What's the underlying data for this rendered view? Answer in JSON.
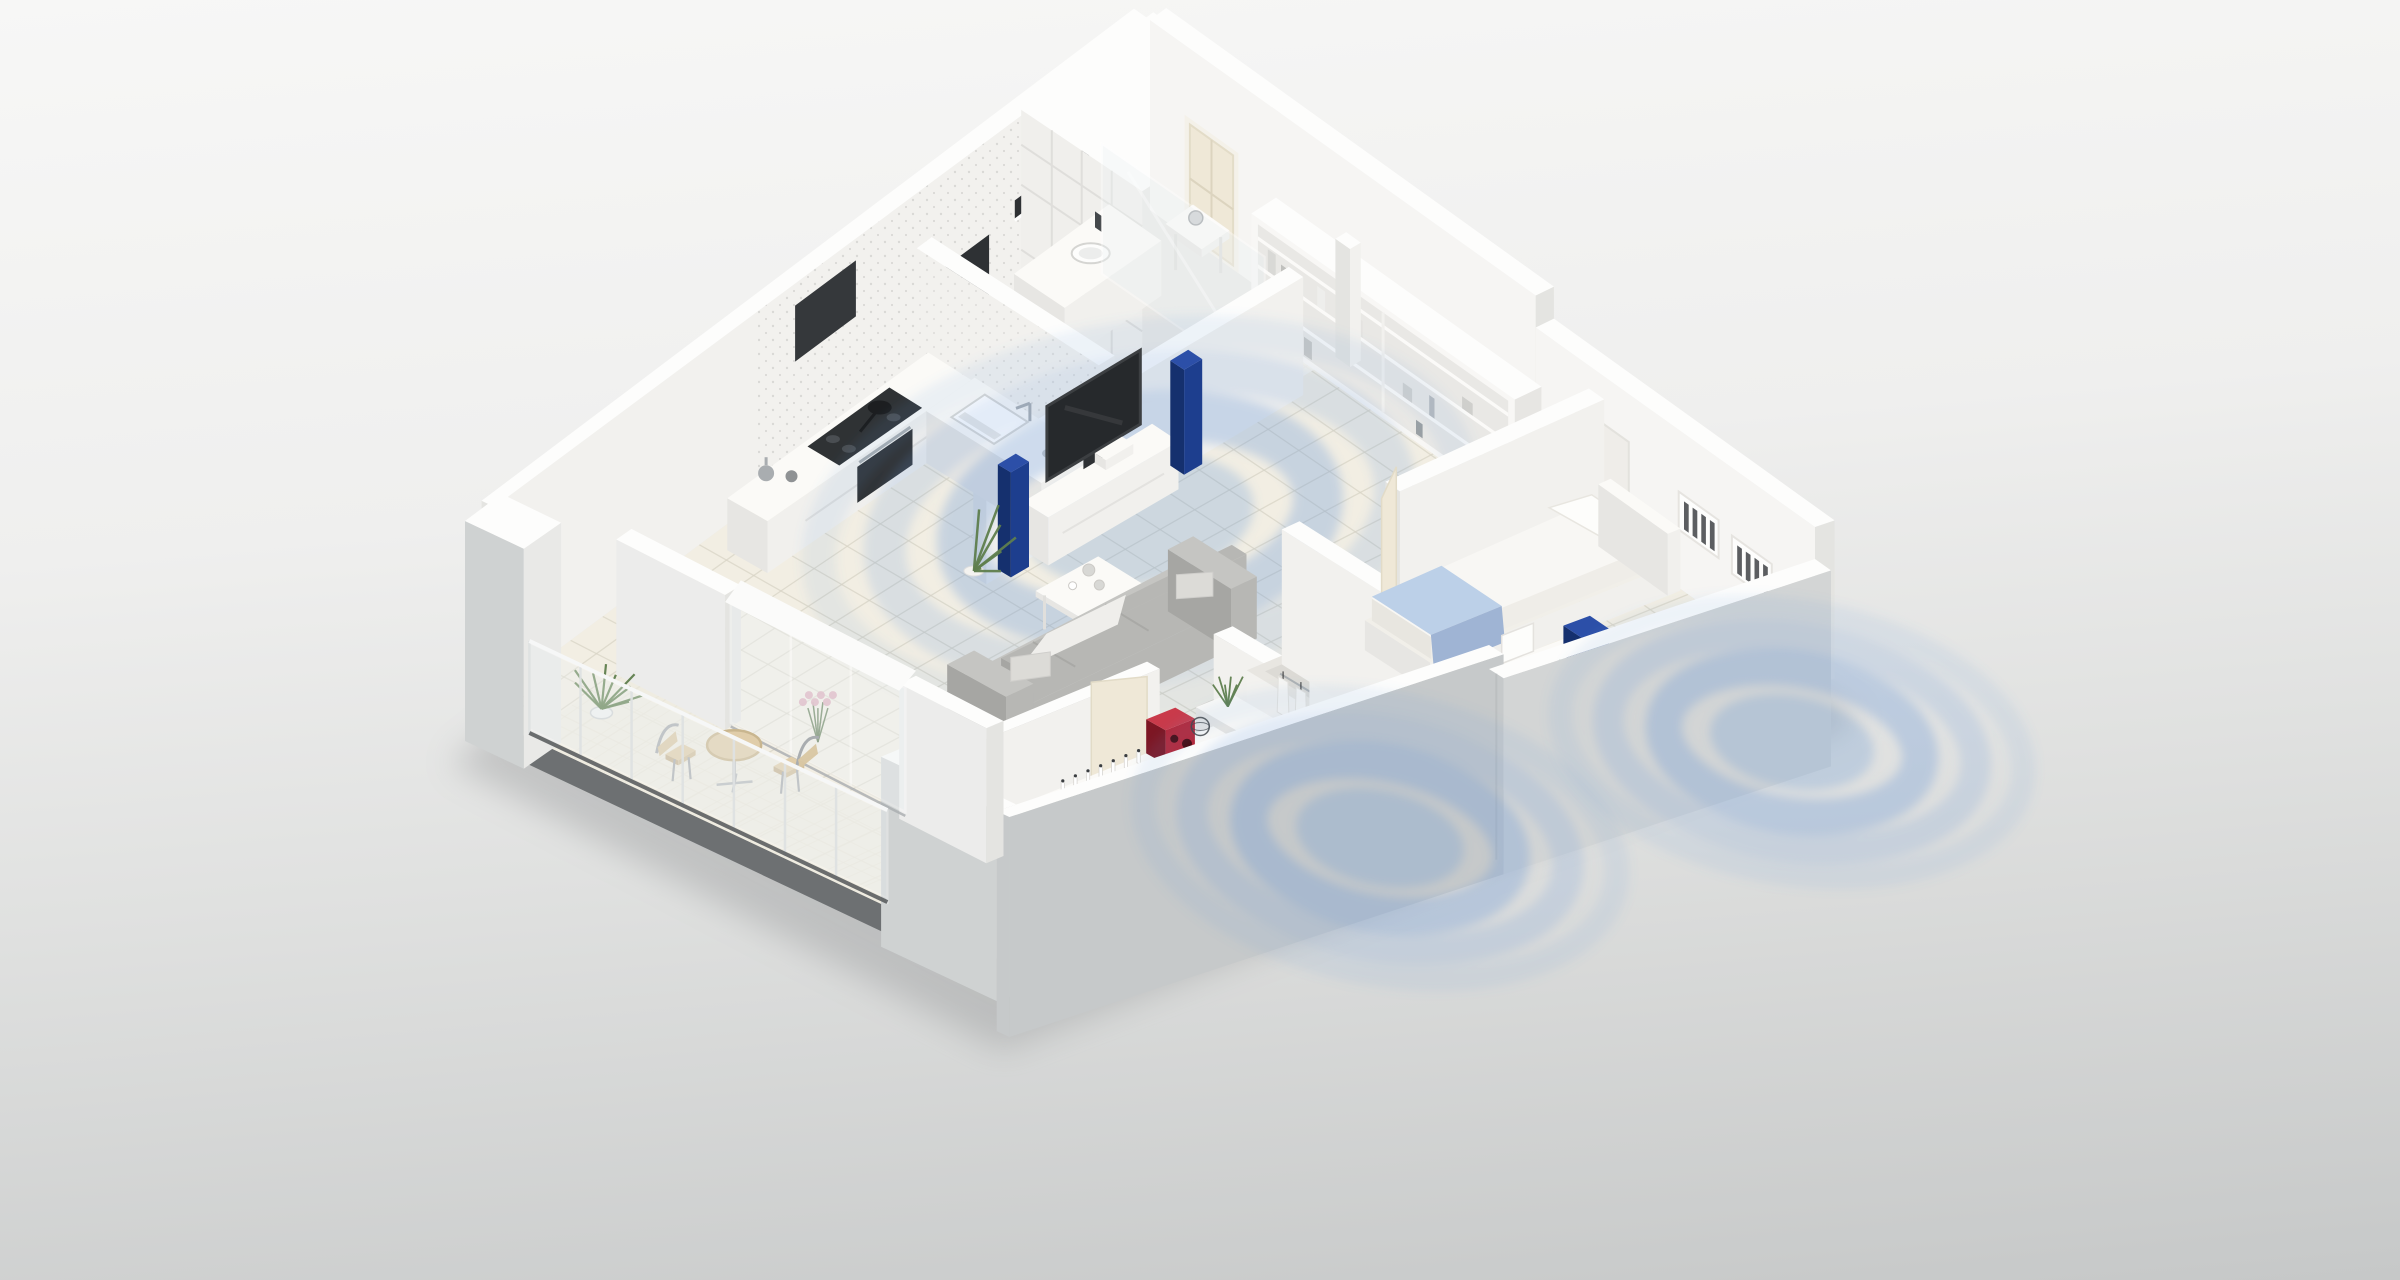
{
  "image": {
    "kind": "3d-isometric-apartment-cutaway-render",
    "style": "white monochrome architectural model, cutaway walls, viewed from above at an angle",
    "visible_text": "none",
    "overlay": "translucent blue concentric sound-coverage rings in three rooms"
  },
  "apartment": {
    "rooms": [
      {
        "name": "living-room",
        "furniture": [
          "media-console",
          "tv",
          "tower-speaker-left",
          "tower-speaker-right",
          "floor-plant",
          "coffee-table-large",
          "coffee-table-small",
          "sofa",
          "throw-blanket",
          "flower-bouquet",
          "grass-plant"
        ]
      },
      {
        "name": "kitchen",
        "furniture": [
          "l-shaped-counter",
          "gas-cooktop",
          "frying-pan",
          "built-in-oven",
          "range-hood",
          "sink",
          "faucet",
          "decor-vases",
          "glass-sphere"
        ]
      },
      {
        "name": "bathroom",
        "furniture": [
          "vanity",
          "round-sink",
          "faucet",
          "mirror-shelf",
          "washing-machine",
          "tall-grid-cabinet",
          "glass-partition"
        ]
      },
      {
        "name": "hallway",
        "furniture": [
          "entry-door",
          "console-table",
          "decor-sphere",
          "wall-shelf-unit"
        ]
      },
      {
        "name": "bedroom-main",
        "furniture": [
          "wall-sideboard",
          "cube-speaker-red-top",
          "cube-speaker-red-low",
          "decor-bottles",
          "wire-sphere",
          "double-bed",
          "pillows",
          "blue-runner",
          "foot-blanket",
          "dresser",
          "pebbles",
          "grass-tuft"
        ]
      },
      {
        "name": "walk-in-closet",
        "furniture": [
          "wardrobe-row-1",
          "wardrobe-row-2",
          "hanging-clothes"
        ]
      },
      {
        "name": "bedroom-second",
        "furniture": [
          "single-bed",
          "pillows",
          "pale-blue-blanket",
          "desk",
          "chair",
          "cube-speaker-navy-desk",
          "cube-speaker-navy-floor",
          "desk-plant",
          "book-shelf-1",
          "book-shelf-2",
          "window-ledge",
          "decor-ball"
        ]
      },
      {
        "name": "balcony",
        "furniture": [
          "glass-railing",
          "potted-plant",
          "bistro-table",
          "bistro-chair-1",
          "bistro-chair-2"
        ]
      }
    ],
    "audio_zones": [
      {
        "room": "living-room",
        "source": "blue tower speakers",
        "rings": 4
      },
      {
        "room": "bedroom-main",
        "source": "red cube speakers",
        "rings": 4
      },
      {
        "room": "bedroom-second",
        "source": "navy cube speakers",
        "rings": 4
      }
    ]
  },
  "colors": {
    "bg_top": "#f7f7f6",
    "bg_bottom": "#c6c8c8",
    "shadow": "#96989a",
    "slab": "#6d7072",
    "floor": "#f2eee3",
    "floor_bath": "#f7f5ee",
    "floor_balcony": "#eeebdf",
    "tile": "#d8d4c6",
    "wall_top": "#fdfdfc",
    "wall_in": "#f2f1ee",
    "wall_in2": "#f6f5f3",
    "wall_side": "#e4e4e1",
    "front_gray": "#c6c9ca",
    "front_gray2": "#d3d5d5",
    "left_gray": "#cfd2d2",
    "furn_top": "#fbfaf7",
    "furn_front": "#f1f0ed",
    "furn_side": "#e7e6e3",
    "glass": "#eef3f5",
    "steel": "#a9adb0",
    "dark": "#2e3134",
    "screen": "#26292c",
    "wave": "#6496d6",
    "navy_front": "#1d3e8e",
    "navy_side": "#15306e",
    "navy_top": "#2c4fa8",
    "red_front": "#b52536",
    "red_side": "#7d1623",
    "red_top": "#c93a4a",
    "sofa": "#b7b7b4",
    "sofa_dark": "#a6a6a3",
    "sofa_light": "#c5c5c2",
    "throw": "#efeeeb",
    "bed": "#f8f7f4",
    "bed_shadow": "#e8e6e0",
    "blanket_blue": "#bcd0e8",
    "blanket_blue2": "#9fb4d4",
    "runner_blue": "#8fa8cc",
    "sage": "#aec4ba",
    "green": "#5f7f4e",
    "green_dark": "#48663a",
    "cream_door": "#efe8d7",
    "beige": "#e0cdaa",
    "beige_rim": "#c9b68f",
    "pink": "#d8a2b2",
    "terrazzo": "#c9c9c6",
    "books": "#3f4245"
  }
}
